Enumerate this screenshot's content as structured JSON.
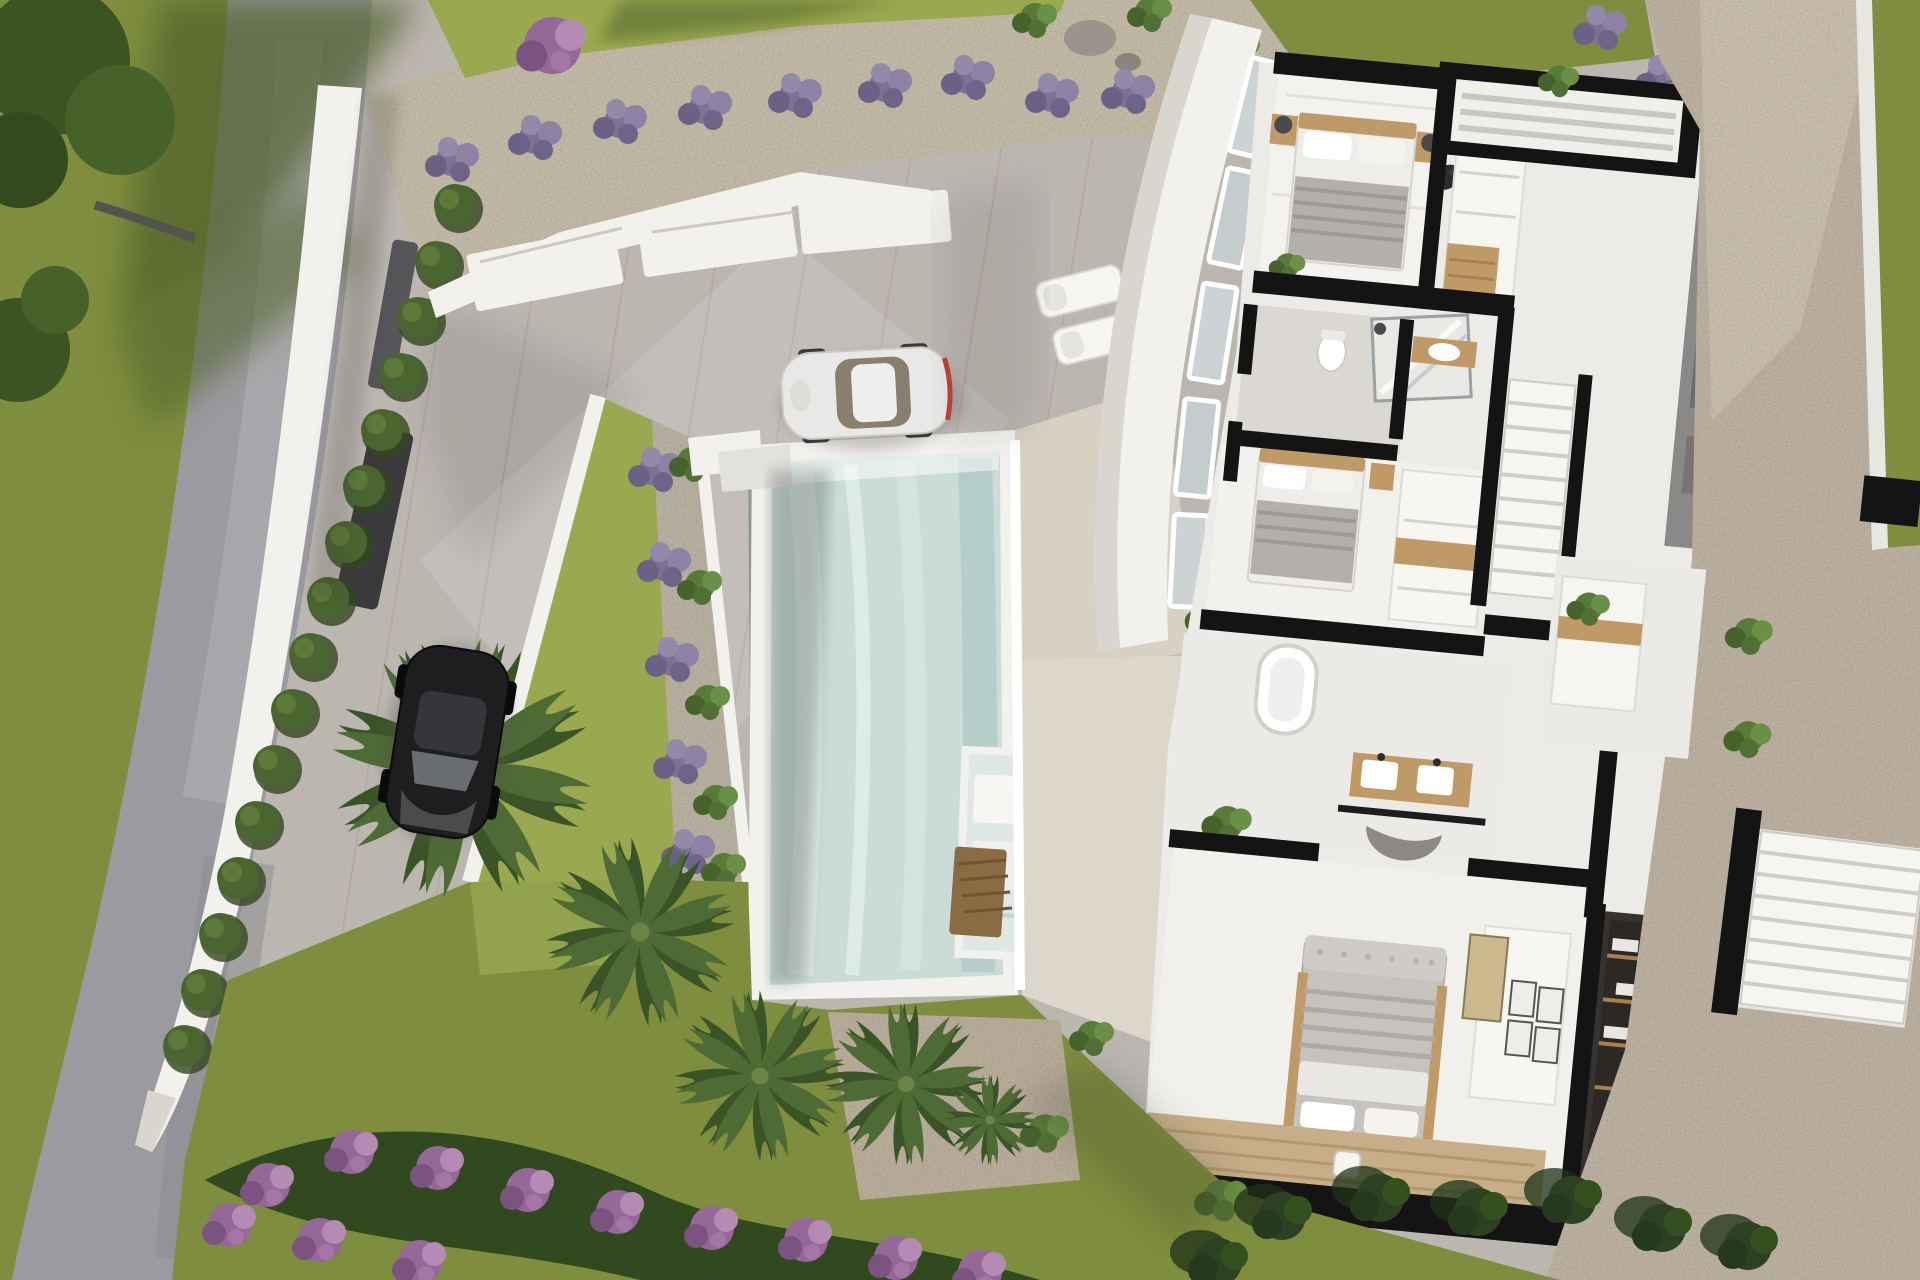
{
  "scene": {
    "kind": "architectural-3d-render",
    "view": "top-down aerial",
    "subject": "modern two-storey villa cutaway floor plan with pool, terraced garden, driveway and street",
    "time_of_day": "late afternoon sun from upper right, long soft shadows"
  },
  "palette": {
    "grass": "#7e8d3e",
    "grass-sun": "#9aa94f",
    "grass-shade": "#5f6e33",
    "road": "#9b9aa0",
    "road-light": "#aeadb2",
    "pave": "#bcb6b1",
    "pave-light": "#cfc9c3",
    "gravel": "#cdc4b1",
    "gravel-dark": "#b4aa95",
    "stone": "#c6bbaa",
    "pool": "#c9dcd8",
    "pool-light": "#dfeae5",
    "pool-deep": "#aec7c4",
    "white": "#f2f1ee",
    "offwhite": "#e4e2dd",
    "deck": "#d8d1c3",
    "plan-floor": "#edebe7",
    "tile": "#dbd8d4",
    "wall-black": "#141414",
    "gray-wall": "#8b8987",
    "charcoal": "#3a3a3c",
    "wood": "#c09a66",
    "wood-floor": "#c7ae89",
    "hedge": "#4a6530",
    "palm": "#4e6b35",
    "palm-dark": "#3a5428",
    "lavender": "#7d7295",
    "flower": "#96689a",
    "dark-bush": "#2c4122",
    "bed-gray": "#b7b4b0",
    "car-white": "#e9e8e6",
    "car-black": "#1e1e20",
    "glass": "#cdd3d4"
  },
  "inventory": {
    "cars": [
      {
        "color_name": "white",
        "location": "upper driveway",
        "heading": "parked facing left"
      },
      {
        "color_name": "black",
        "location": "lower driveway by hedge",
        "heading": "parked facing down"
      }
    ],
    "pool": {
      "shape": "rectangular",
      "attached_sun_shelf_loungers": 2
    },
    "sun_loungers_on_terrace": 2,
    "palm_trees": 4,
    "lavender_bushes": 12,
    "cypress_hedge_plants": 16,
    "bedrooms_visible": 3,
    "bathrooms_visible": 2,
    "staircases_visible": 2,
    "walk_in_wardrobe": 1,
    "flower_bed": "purple bougainvillea band along lower garden",
    "street": "curved gray road along left edge"
  }
}
